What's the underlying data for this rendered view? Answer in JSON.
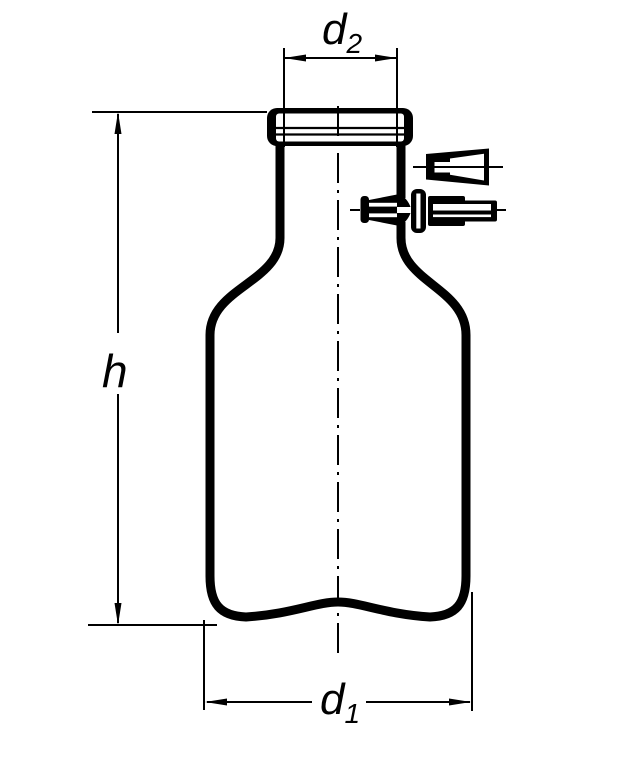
{
  "figure": {
    "kind": "technical line drawing",
    "ink_color": "#000000",
    "background_color": "#ffffff"
  },
  "dimension_labels": {
    "neck_diameter": {
      "symbol": "d",
      "subscript": "2"
    },
    "overall_height": {
      "symbol": "h",
      "subscript": ""
    },
    "body_diameter": {
      "symbol": "d",
      "subscript": "1"
    }
  }
}
